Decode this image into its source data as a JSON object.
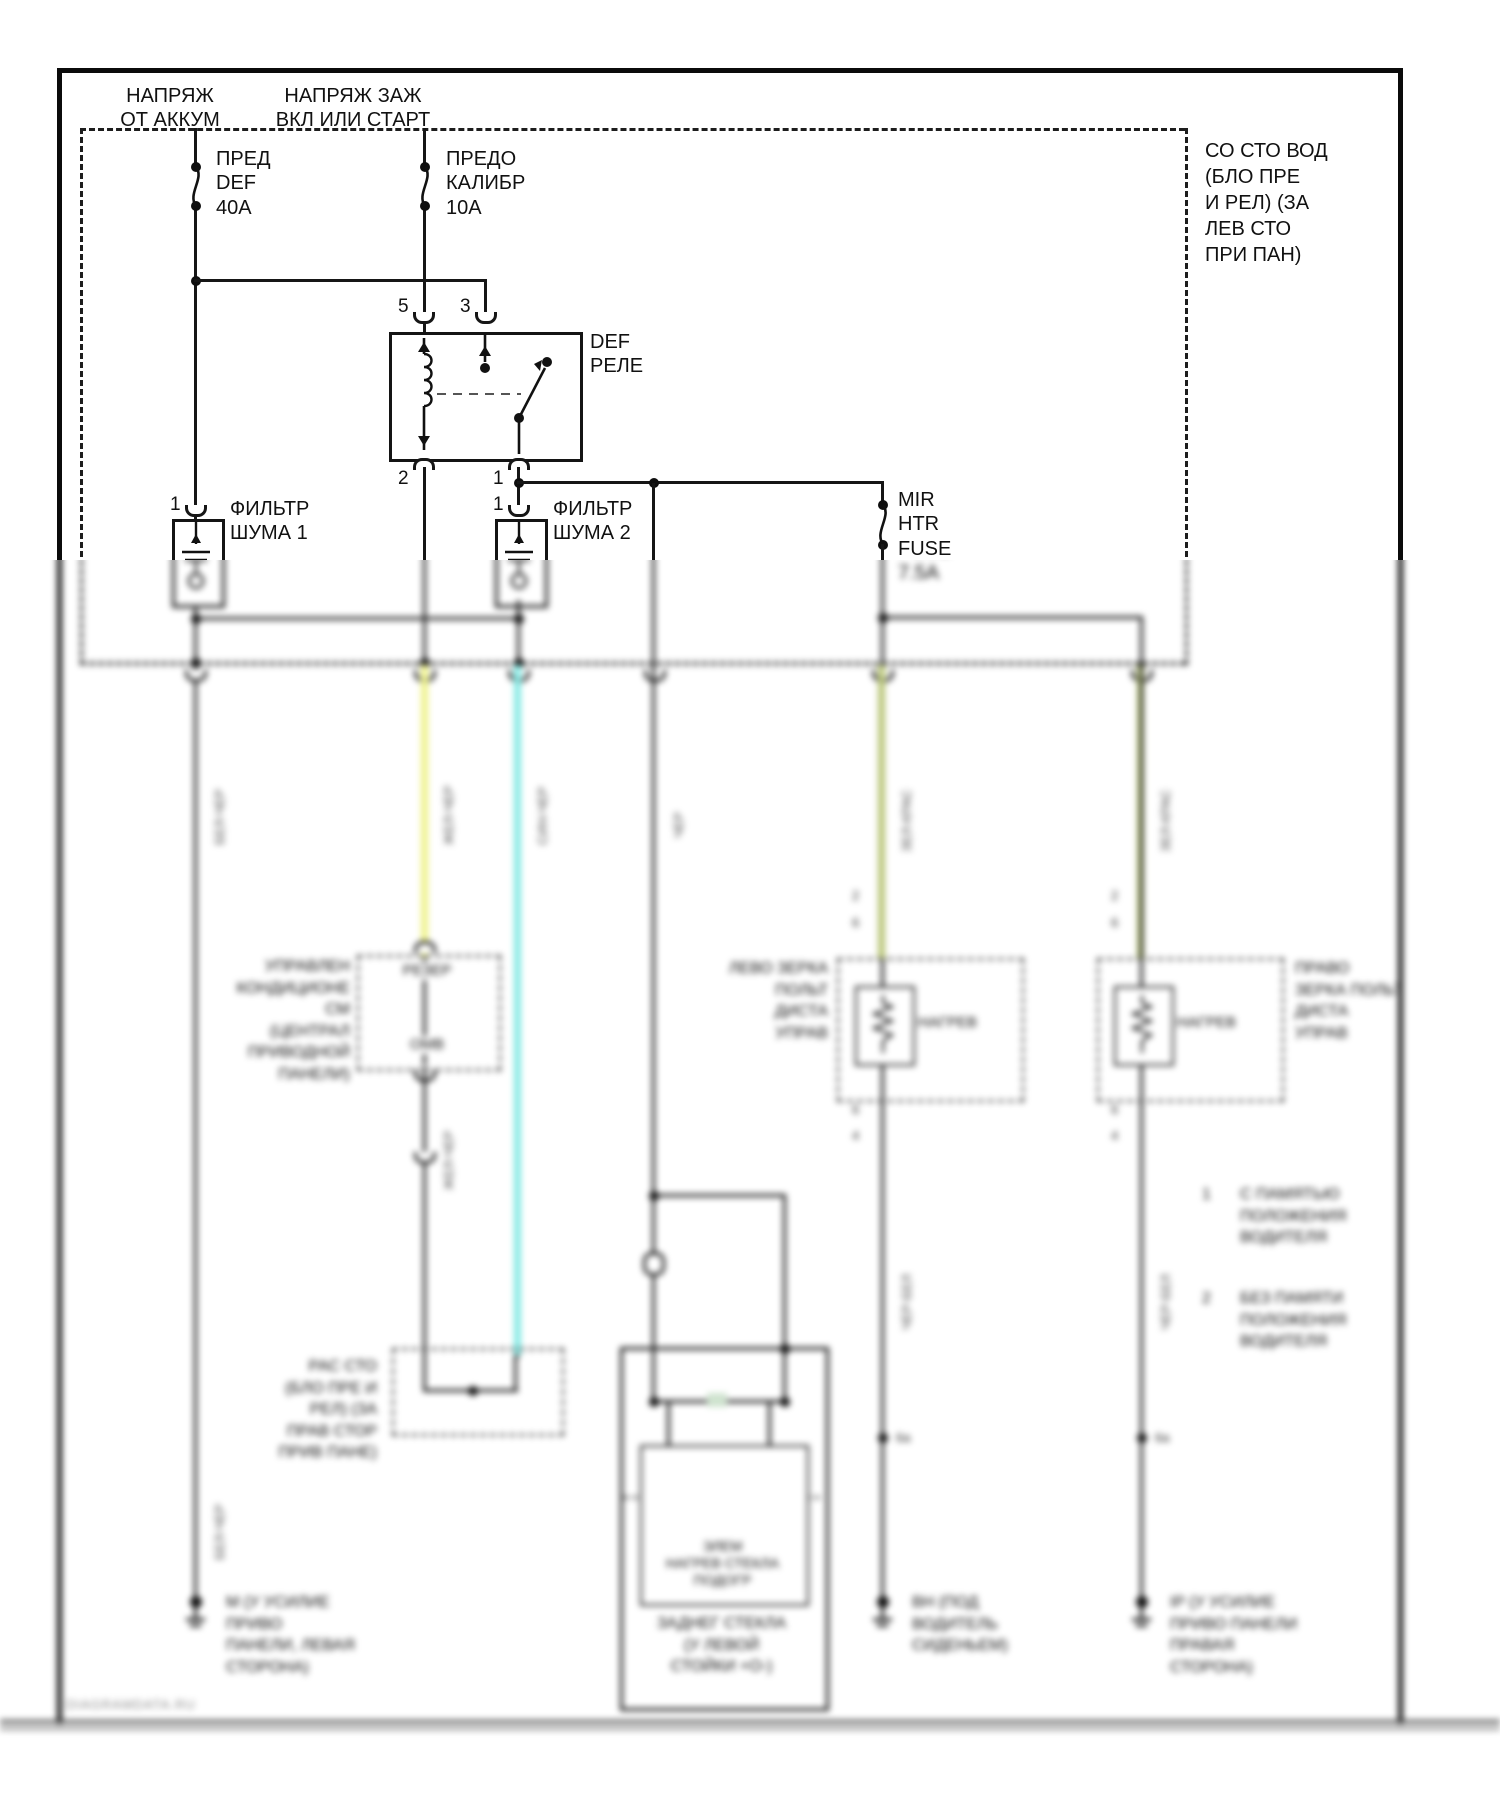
{
  "colors": {
    "wire_yellow": "#eef289",
    "wire_cyan": "#83e9e4",
    "wire_olive": "#b9c678",
    "line": "#161616"
  },
  "feeds": {
    "battery": [
      "НАПРЯЖ",
      "ОТ АККУМ"
    ],
    "ignition": [
      "НАПРЯЖ ЗАЖ",
      "ВКЛ ИЛИ СТАРТ"
    ]
  },
  "fuses": {
    "def": [
      "ПРЕД",
      "DEF",
      "40А"
    ],
    "gauge": [
      "ПРЕДО",
      "КАЛИБР",
      "10А"
    ],
    "mir": [
      "MIR",
      "HTR",
      "FUSE",
      "7.5А"
    ]
  },
  "relay": {
    "name": [
      "DEF",
      "РЕЛЕ"
    ],
    "pin5": "5",
    "pin3": "3",
    "pin2": "2",
    "pin1": "1"
  },
  "filters": {
    "f1": {
      "pin": "1",
      "label": [
        "ФИЛЬТР",
        "ШУМА 1"
      ]
    },
    "f2": {
      "pin": "1",
      "label": [
        "ФИЛЬТР",
        "ШУМА 2"
      ]
    }
  },
  "junction_note": [
    "СО СТО ВОД",
    "(БЛО ПРЕ",
    "И РЕЛ) (ЗА",
    "ЛЕВ СТО",
    "ПРИ ПАН)"
  ],
  "wire_labels": {
    "w1": "БЕЛ-ЧЕР",
    "w2": "ЖЕЛ-ЧЕР",
    "w3": "СИН-ЧЕР",
    "w4": "ЧЕР",
    "w5": "ЗЕЛ-КРАС",
    "w6": "ЗЕЛ-КРАС",
    "w1b": "БЕЛ-ЧЕР",
    "w2b": "ЖЕЛ-ЧЕР",
    "w5b": "ЧЕР-БЕЛ",
    "w6b": "ЧЕР-БЕЛ"
  },
  "ac_unit": {
    "label": [
      "УПРАВЛЕН",
      "КОНДИЦИОНЕ",
      "СМ",
      "(ЦЕНТРАЛ",
      "ПРИВОДНОЙ",
      "ПАНЕЛИ)"
    ],
    "inner_top": "РЕЗЕР",
    "inner_bottom": "ОМВ"
  },
  "splice": {
    "note": [
      "РАС СТО",
      "(БЛО ПРЕ И",
      "РЕЛ) (ЗА",
      "ПРАВ СТОР",
      "ПРИВ ПАНЕ)"
    ],
    "id_left": "6а",
    "id_right": "6а"
  },
  "mirrors": {
    "left": {
      "label": [
        "ЛЕВО ЗЕРКА",
        "ПОЛЬТ",
        "ДИСТА",
        "УПРАВ"
      ],
      "heater": "НАГРЕВ",
      "pins": [
        "2",
        "6",
        "6",
        "4"
      ]
    },
    "right": {
      "label": [
        "ПРАВО",
        "ЗЕРКА ПОЛЬТ",
        "ДИСТА",
        "УПРАВ"
      ],
      "heater": "НАГРЕВ",
      "pins": [
        "2",
        "6",
        "6",
        "4"
      ]
    }
  },
  "rear_window": {
    "element": [
      "ЭЛЕМ",
      "НАГРЕВ СТЕКЛА",
      "ПОДОГР"
    ],
    "caption": [
      "ЗАДНЕГ СТЕКЛА",
      "(У ЛЕВОЙ",
      "СТОЙКИ +О-)"
    ]
  },
  "notes": {
    "n1": {
      "num": "1",
      "lines": [
        "С ПАМЯТЬЮ",
        "ПОЛОЖЕНИЯ",
        "ВОДИТЕЛЯ"
      ]
    },
    "n2": {
      "num": "2",
      "lines": [
        "БЕЗ ПАМЯТИ",
        "ПОЛОЖЕНИЯ",
        "ВОДИТЕЛЯ"
      ]
    }
  },
  "grounds": {
    "g1": [
      "М (У УСИЛИЕ",
      "ПРИВО",
      "ПАНЕЛИ, ЛЕВАЯ",
      "СТОРОНА)"
    ],
    "g2": [
      "ВН (ПОД",
      "ВОДИТЕЛЬ",
      "СИДЕНЬЕМ)"
    ],
    "g3": [
      "IP (У УСИЛИЕ",
      "ПРИВО ПАНЕЛИ",
      "ПРАВАЯ",
      "СТОРОНА)"
    ]
  },
  "watermark": "DIAGRAMDATA.RU"
}
